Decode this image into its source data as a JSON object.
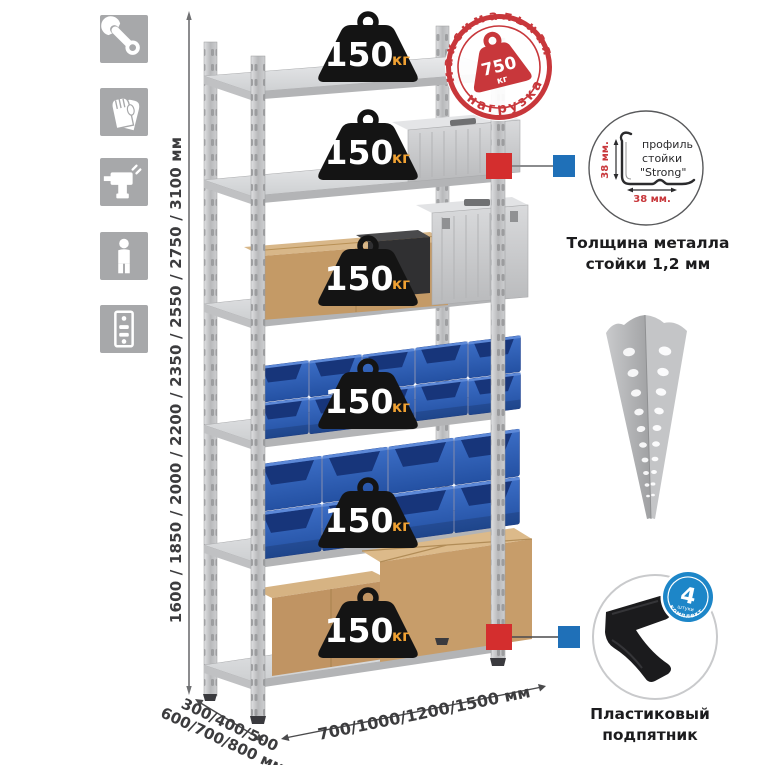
{
  "side_icons": [
    {
      "name": "wrench"
    },
    {
      "name": "gloves"
    },
    {
      "name": "drill"
    },
    {
      "name": "person-height"
    },
    {
      "name": "shelving-rack"
    }
  ],
  "rack": {
    "shelf_count": 6
  },
  "dimensions": {
    "height": "1600 / 1850 / 2000 / 2200 / 2350 / 2550 / 2750 / 3100 мм",
    "depth_line1": "300/400/500",
    "depth_line2": "600/700/800 мм",
    "width": "700/1000/1200/1500 мм"
  },
  "shelf_badge": {
    "value": "150",
    "unit": "кг"
  },
  "max_load_stamp": {
    "arc_top": "максимальная",
    "arc_bottom": "нагрузка",
    "value": "750",
    "unit": "кг"
  },
  "profile_detail": {
    "label_line1": "профиль",
    "label_line2": "стойки",
    "label_line3": "\"Strong\"",
    "dim_vertical": "38 мм.",
    "dim_horizontal": "38 мм.",
    "caption_line1": "Толщина металла",
    "caption_line2": "стойки 1,2 мм"
  },
  "foot_detail": {
    "badge_number": "4",
    "badge_word": "штуки",
    "badge_arc": "в комплекте",
    "caption_line1": "Пластиковый",
    "caption_line2": "подпятник"
  },
  "colors": {
    "stamp_red": "#c8373b",
    "connector_red": "#d42e2e",
    "connector_blue": "#1f70b8",
    "badge_black": "#141414",
    "unit_orange": "#f0a132",
    "bin_blue": "#2f5fb5",
    "metal_grey": "#c6c7c9",
    "icon_grey": "#a7a8aa",
    "foot_badge_blue": "#1d86c8"
  }
}
